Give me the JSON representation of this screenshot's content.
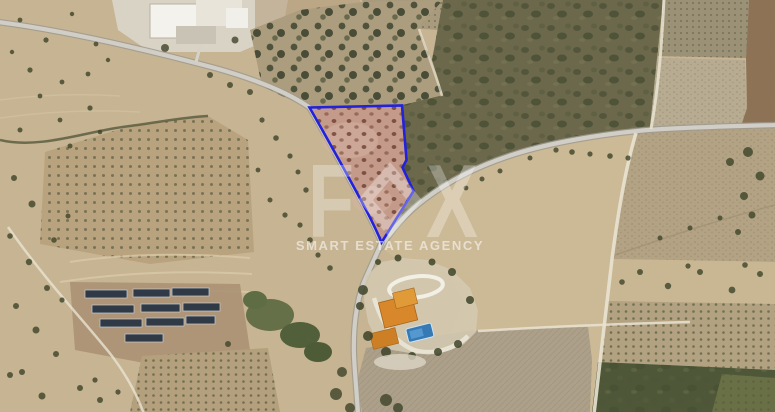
{
  "watermark": {
    "logo": {
      "f": "F",
      "x": "X",
      "diamond_icon": "diamond"
    },
    "tagline": "SMART ESTATE AGENCY"
  },
  "colors": {
    "plot_outline": "#2222dd",
    "plot_soil": "#c49a8b",
    "plot_tree": "#6e3e30",
    "road": "#d0cec6",
    "road_edge": "#9f9a8e",
    "track": "#e9e3d1",
    "field_tan": "#c6b492",
    "field_light": "#ccb996",
    "scrub_dark": "#6b684b",
    "vegetation_dark": "#3e4429",
    "orchard_soil": "#b9a37f",
    "roof_orange": "#d8872b",
    "pool_blue": "#3579b5",
    "solar_panel": "#303a46",
    "villa_white": "#f4f2ec",
    "watermark_white": "#ffffff"
  }
}
